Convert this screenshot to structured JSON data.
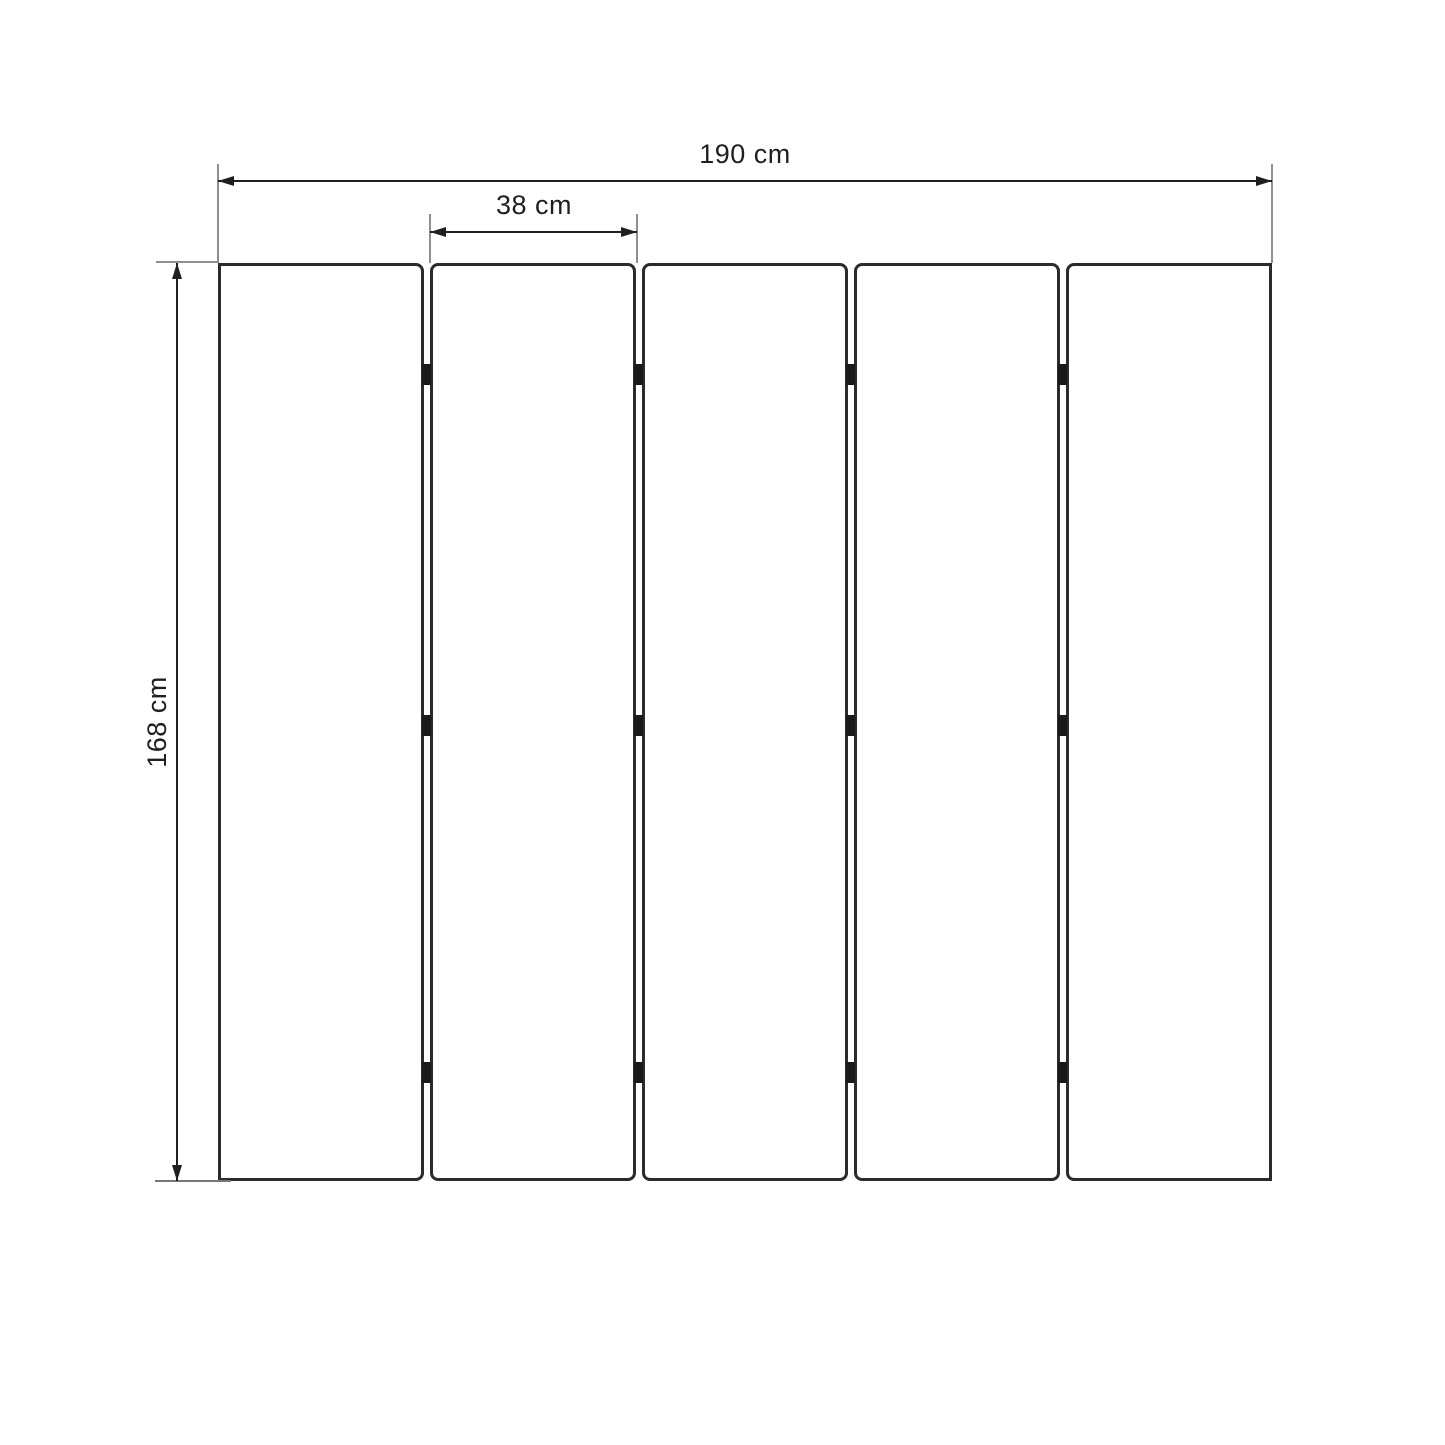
{
  "diagram": {
    "kind": "dimension-drawing",
    "subject": "five-panel folding screen, front elevation",
    "structure": {
      "panel_count": 5,
      "gap_count": 4,
      "hinges_per_gap": 3
    },
    "dimensions": {
      "total_width_label": "190 cm",
      "panel_width_label": "38 cm",
      "height_label": "168 cm"
    },
    "colors": {
      "background": "#ffffff",
      "panel_border": "#2b2b2b",
      "dimension_line": "#1f1f1f",
      "extension_line": "#8f8f8f",
      "hinge": "#1a1a1a",
      "label_text": "#1f1f1f"
    }
  }
}
